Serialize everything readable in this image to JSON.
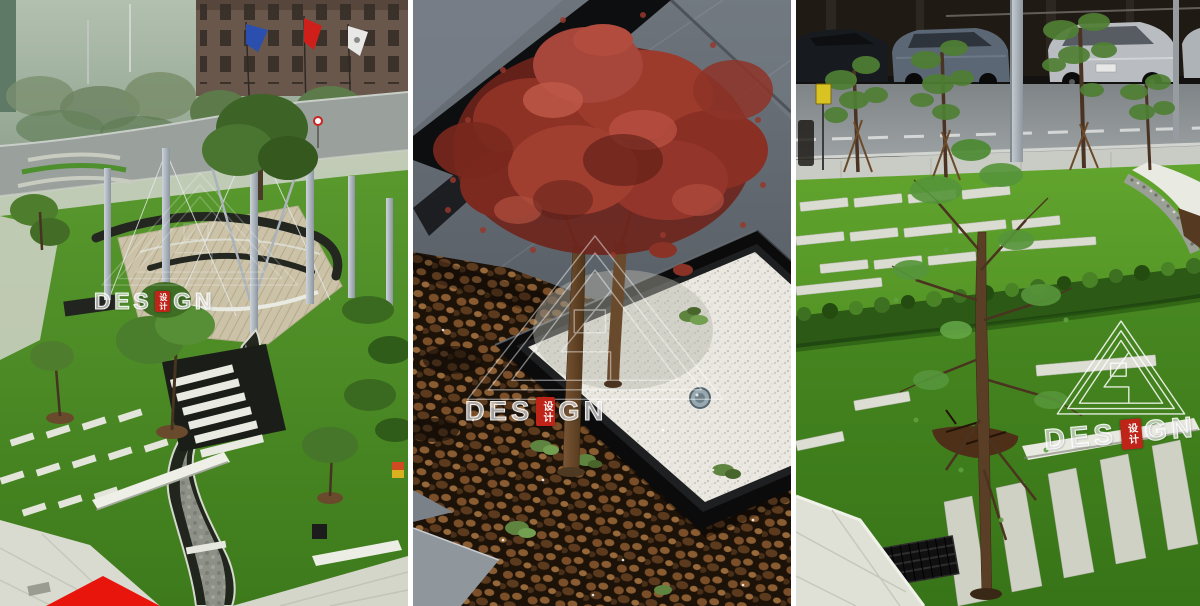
{
  "collage": {
    "watermark": {
      "prefix": "DES",
      "suffix": "GN",
      "seal": "设计"
    },
    "panels": [
      {
        "name": "aerial-plaza-garden"
      },
      {
        "name": "red-maple-gravel-planter"
      },
      {
        "name": "lawn-with-paving-strips"
      }
    ],
    "accent": {
      "corner_triangle": "#e8150c",
      "seal_red": "#bf2418",
      "watermark_white": "#ffffff"
    }
  }
}
